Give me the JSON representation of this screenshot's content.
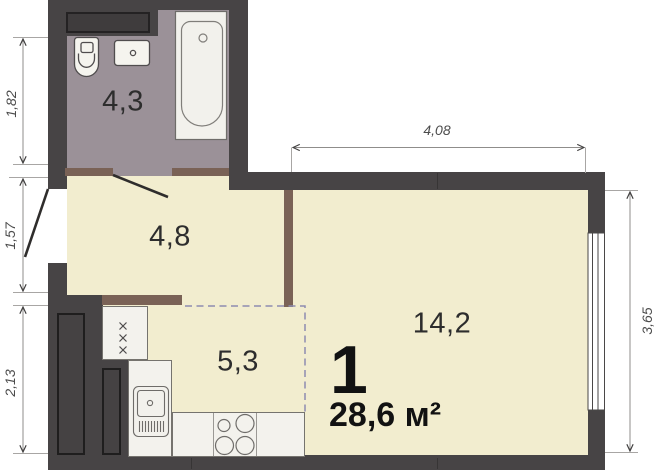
{
  "summary": {
    "rooms_count": "1",
    "total_area": "28,6 м²"
  },
  "rooms": {
    "bathroom": {
      "area": "4,3"
    },
    "hallway": {
      "area": "4,8"
    },
    "kitchen": {
      "area": "5,3"
    },
    "living": {
      "area": "14,2"
    }
  },
  "dimensions_m": {
    "left_top": "1,82",
    "left_middle": "1,57",
    "left_bottom": "2,13",
    "top": "4,08",
    "right": "3,65"
  },
  "colors": {
    "wall": "#474445",
    "floor": "#f2edcf",
    "bathroom_floor": "#9b9198",
    "door_sill": "#7a6256",
    "kitchen_zone_dash": "#8e8cb0",
    "fixtures": "#f3f2ed"
  }
}
